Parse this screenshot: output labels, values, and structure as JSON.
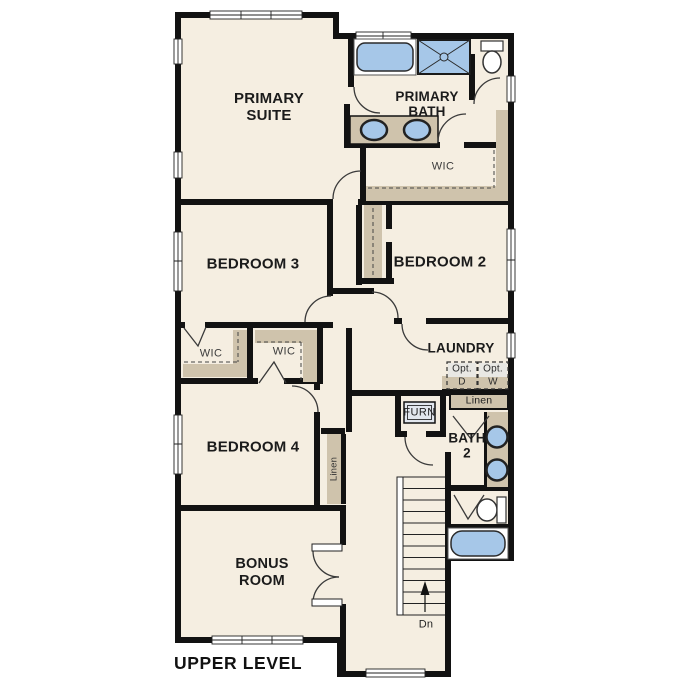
{
  "floorplan": {
    "title": "UPPER LEVEL",
    "rooms": {
      "primary_suite": "PRIMARY\nSUITE",
      "primary_bath": "PRIMARY\nBATH",
      "primary_wic": "WIC",
      "bedroom_3": "BEDROOM 3",
      "bedroom_2": "BEDROOM 2",
      "laundry": "LAUNDRY",
      "wic_left": "WIC",
      "wic_right": "WIC",
      "bedroom_4": "BEDROOM 4",
      "bath_2": "BATH\n2",
      "bonus_room": "BONUS\nROOM"
    },
    "features": {
      "furnace": "FURN",
      "linen_bath": "Linen",
      "linen_hall": "Linen",
      "opt_dryer": "Opt.\nD",
      "opt_washer": "Opt.\nW",
      "stairs_down": "Dn"
    },
    "colors": {
      "wall": "#121212",
      "floor": "#f5eee1",
      "casework": "#cfc3ac",
      "fixture": "#a6c7e8",
      "optional_appliance": "#e9e8e4",
      "furnace_fill": "#e2e7ee"
    }
  }
}
